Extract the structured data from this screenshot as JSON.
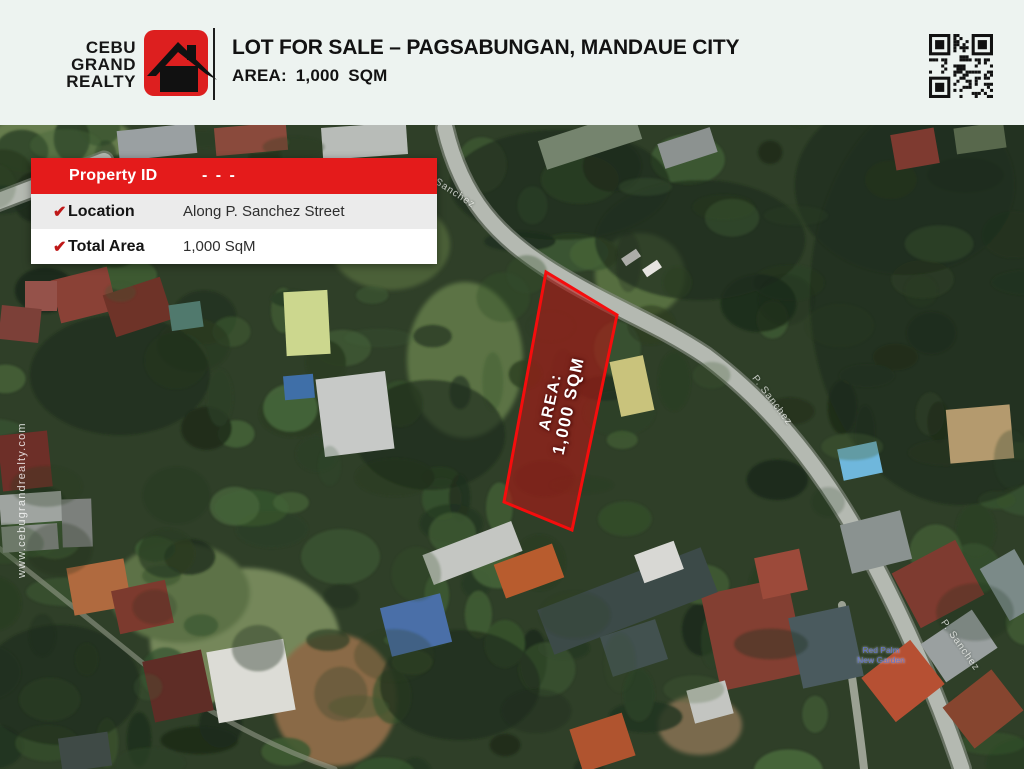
{
  "brand": {
    "lines": [
      "CEBU",
      "GRAND",
      "REALTY"
    ],
    "logo_color": "#dd1f1f"
  },
  "header": {
    "title": "LOT FOR SALE – PAGSABUNGAN, MANDAUE CITY",
    "subtitle": "AREA: 1,000 SQM"
  },
  "property_card": {
    "header_label": "Property ID",
    "header_value": "- - -",
    "rows": [
      {
        "label": "Location",
        "value": "Along P. Sanchez Street"
      },
      {
        "label": "Total Area",
        "value": "1,000 SqM"
      }
    ]
  },
  "lot_overlay": {
    "line1": "AREA:",
    "line2": "1,000 SQM",
    "fill_color": "#c01414",
    "border_color": "#f50d0d"
  },
  "map": {
    "street_labels": [
      {
        "text": "Sanchez"
      },
      {
        "text": "P. Sanchez"
      },
      {
        "text": "P. Sanchez"
      }
    ],
    "poi": {
      "line1": "Red Palm",
      "line2": "New Garden"
    }
  },
  "watermark": "www.cebugrandrealty.com",
  "icons": {
    "check": "✔"
  },
  "colors": {
    "accent_red": "#e41b1b",
    "header_bg": "#edf3f0",
    "map_base_green": "#2f3f28"
  }
}
